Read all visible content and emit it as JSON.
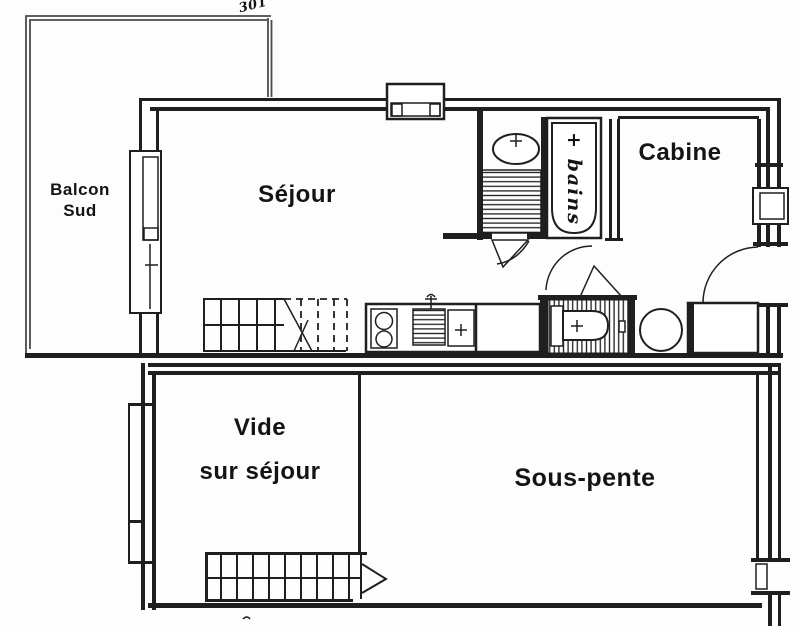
{
  "colors": {
    "line": "#1f1f1f",
    "faint": "#4a4a4a",
    "bg": "#ffffff",
    "paper": "#fdfdfd",
    "text": "#141414"
  },
  "plan": {
    "unit_number": "301",
    "rooms": {
      "balcony": {
        "line1": "Balcon",
        "line2": "Sud"
      },
      "living": {
        "label": "Séjour"
      },
      "cabin": {
        "label": "Cabine"
      },
      "bath": {
        "label": "+ bains"
      },
      "void": {
        "line1": "Vide",
        "line2": "sur séjour"
      },
      "under_slope": {
        "label": "Sous-pente"
      }
    }
  }
}
